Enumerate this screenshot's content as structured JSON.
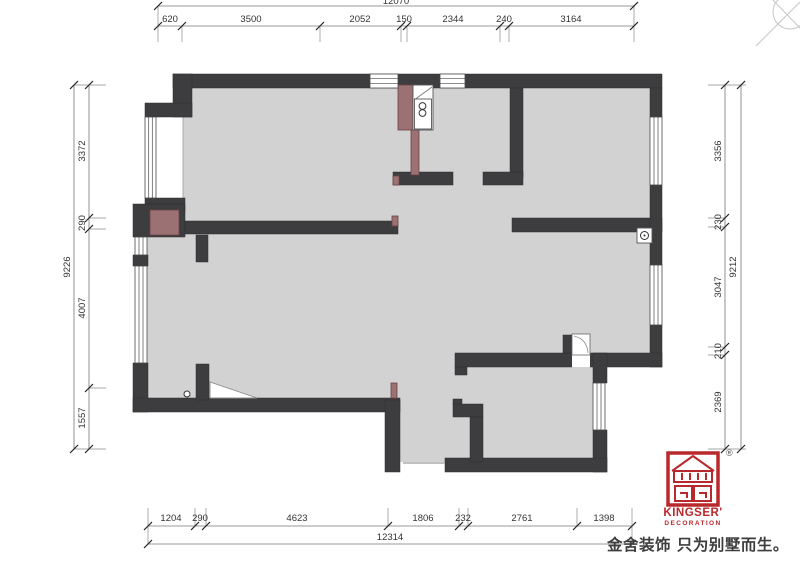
{
  "dims": {
    "top": {
      "total": "12070",
      "segments": [
        "620",
        "3500",
        "2052",
        "150",
        "2344",
        "240",
        "3164"
      ]
    },
    "bottom": {
      "total": "12314",
      "segments": [
        "1204",
        "290",
        "4623",
        "1806",
        "232",
        "2761",
        "1398"
      ]
    },
    "left": {
      "total": "9226",
      "segments": [
        "3372",
        "290",
        "4007",
        "1557"
      ]
    },
    "right": {
      "total": "9212",
      "segments": [
        "3356",
        "230",
        "3047",
        "210",
        "2369"
      ]
    }
  },
  "branding": {
    "name": "KINGSER'",
    "subtitle": "DECORATION",
    "registered_mark": "®",
    "tagline": "金舍装饰 只为别墅而生。",
    "logo_red": "#b9282c"
  },
  "colors": {
    "wall": "#3d3d3f",
    "floor": "#d2d2d2",
    "accent_brown": "#9b7174",
    "dimension_line": "#777777",
    "dimension_text": "#333333",
    "tagline_text": "#3e3e3e"
  }
}
